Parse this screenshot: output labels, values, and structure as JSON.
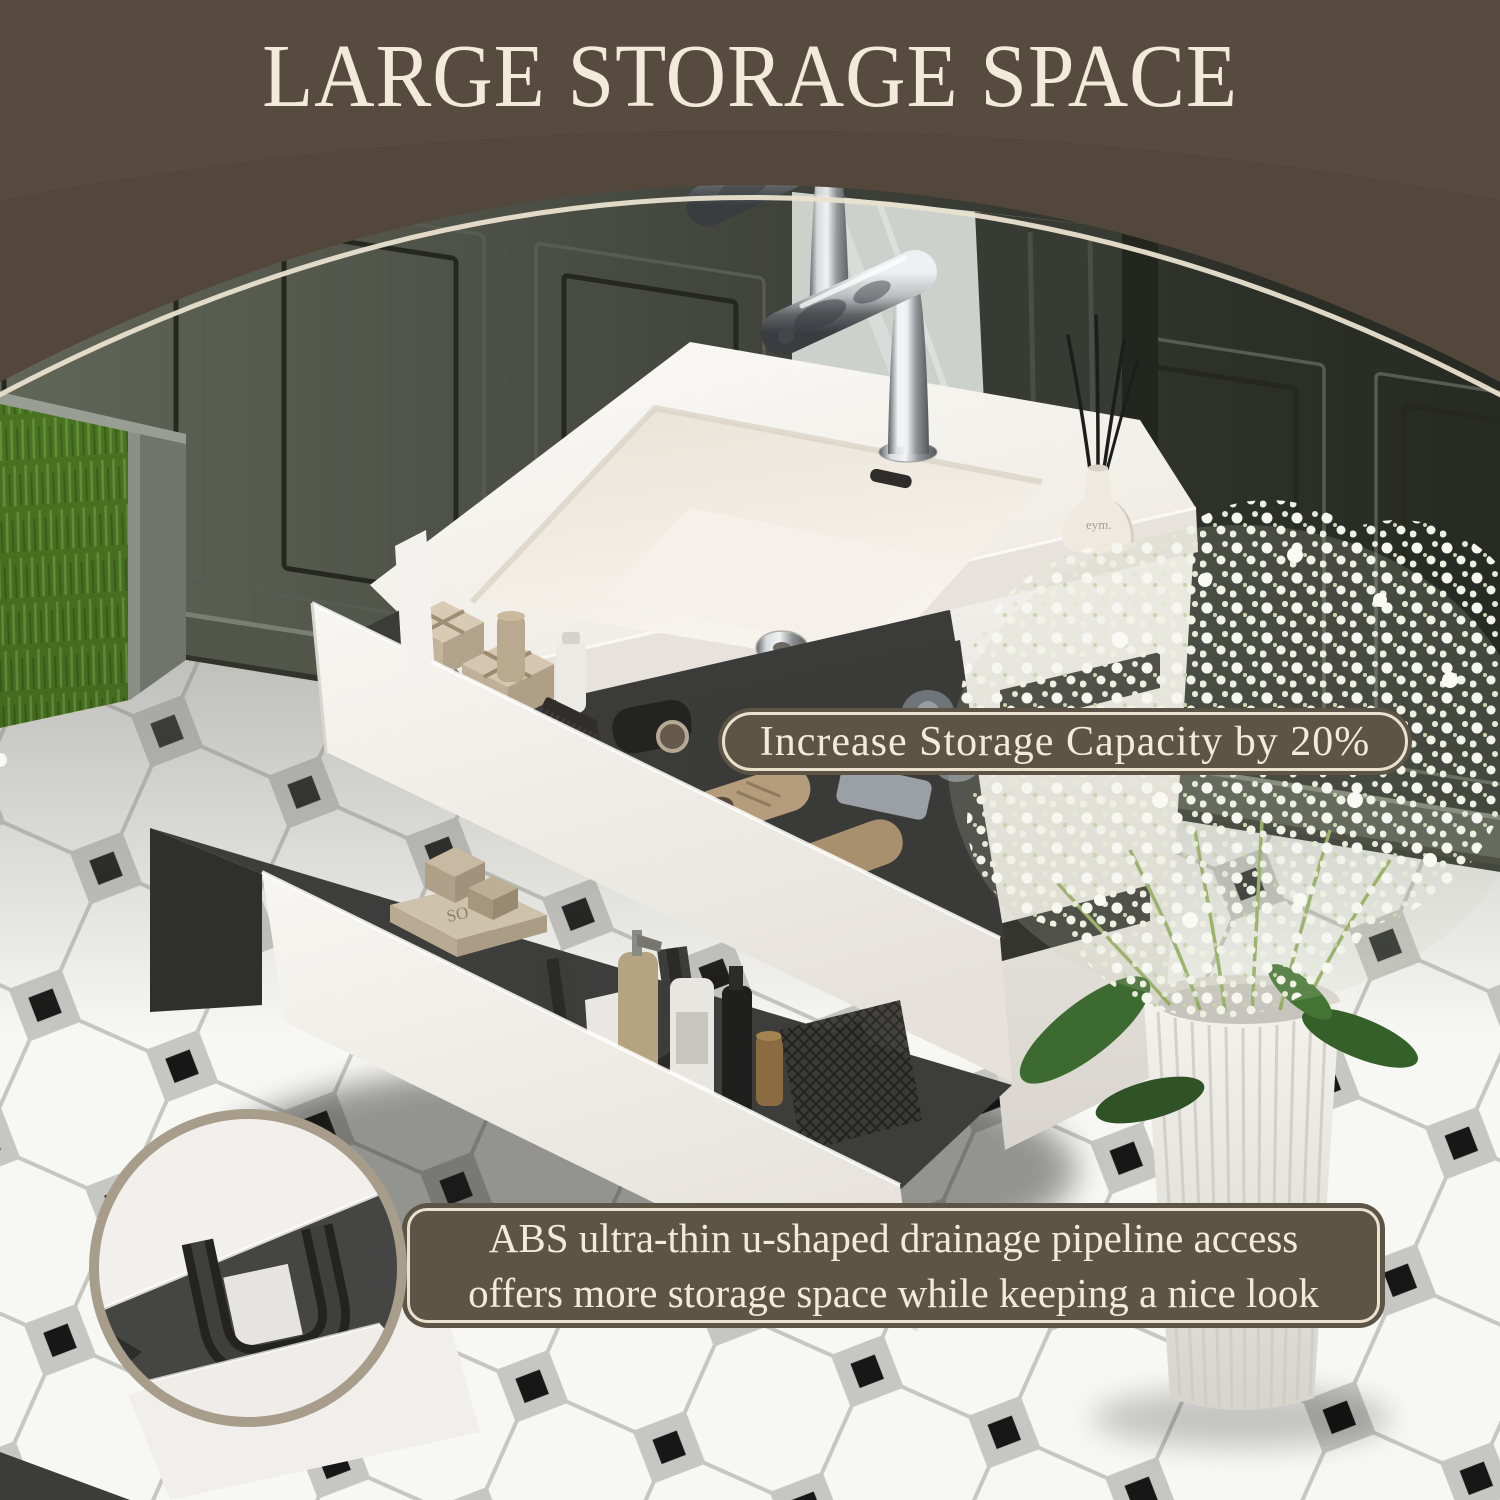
{
  "header": {
    "title": "LARGE STORAGE SPACE"
  },
  "badges": {
    "capacity": {
      "text": "Increase Storage Capacity by 20%"
    }
  },
  "callout": {
    "line1": "ABS ultra-thin u-shaped drainage pipeline access",
    "line2": "offers more storage space while keeping a nice look"
  },
  "product": {
    "diffuser_label": "eym.",
    "box_label": "SO"
  },
  "colors": {
    "header-brown": "#52473a",
    "cream": "#f2ebd9",
    "badge-brown": "#5d5446",
    "badge-border": "#eae2cf",
    "ring-tan": "#a89d8b",
    "wall-dark": "#3f423a",
    "floor-white": "#f7f7f4",
    "tile-dot-black": "#171717"
  }
}
